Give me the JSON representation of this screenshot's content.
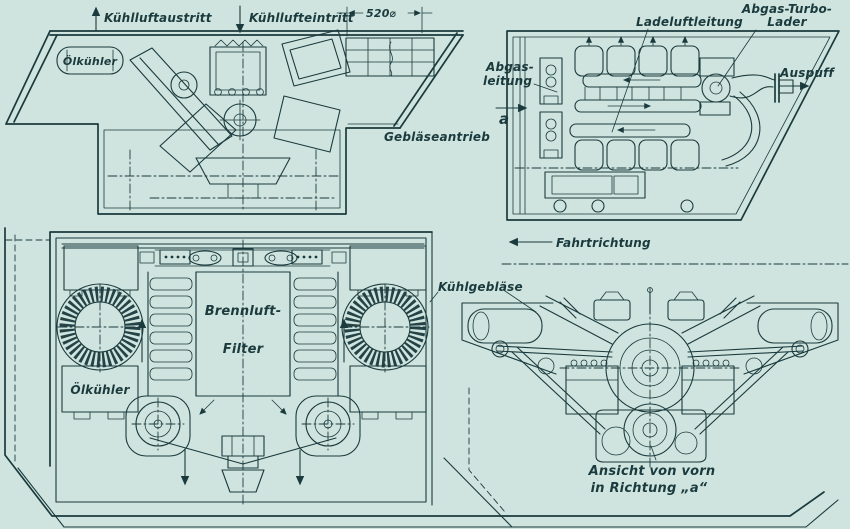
{
  "colors": {
    "background": "#cfe4df",
    "ink": "#1b3a3d"
  },
  "labels": {
    "coolant_air_out": "Kühlluftaustritt",
    "coolant_air_in": "Kühllufteintritt",
    "fan_diameter": "520⌀",
    "oil_cooler_top": "Ölkühler",
    "blower_drive": "Gebläseantrieb",
    "charge_air_line": "Ladeluftleitung",
    "exhaust_turbo_line1": "Abgas-Turbo-",
    "exhaust_turbo_line2": "Lader",
    "exhaust_line1": "Abgas-",
    "exhaust_line2": "leitung",
    "direction_marker": "a",
    "exhaust_outlet": "Auspuff",
    "direction_of_travel": "Fahrtrichtung",
    "cooling_fan": "Kühlgebläse",
    "combustion_air_line1": "Brennluft-",
    "combustion_air_line2": "Filter",
    "oil_cooler_bottom": "Ölkühler",
    "caption_line1": "Ansicht von vorn",
    "caption_line2": "in Richtung „a“"
  }
}
